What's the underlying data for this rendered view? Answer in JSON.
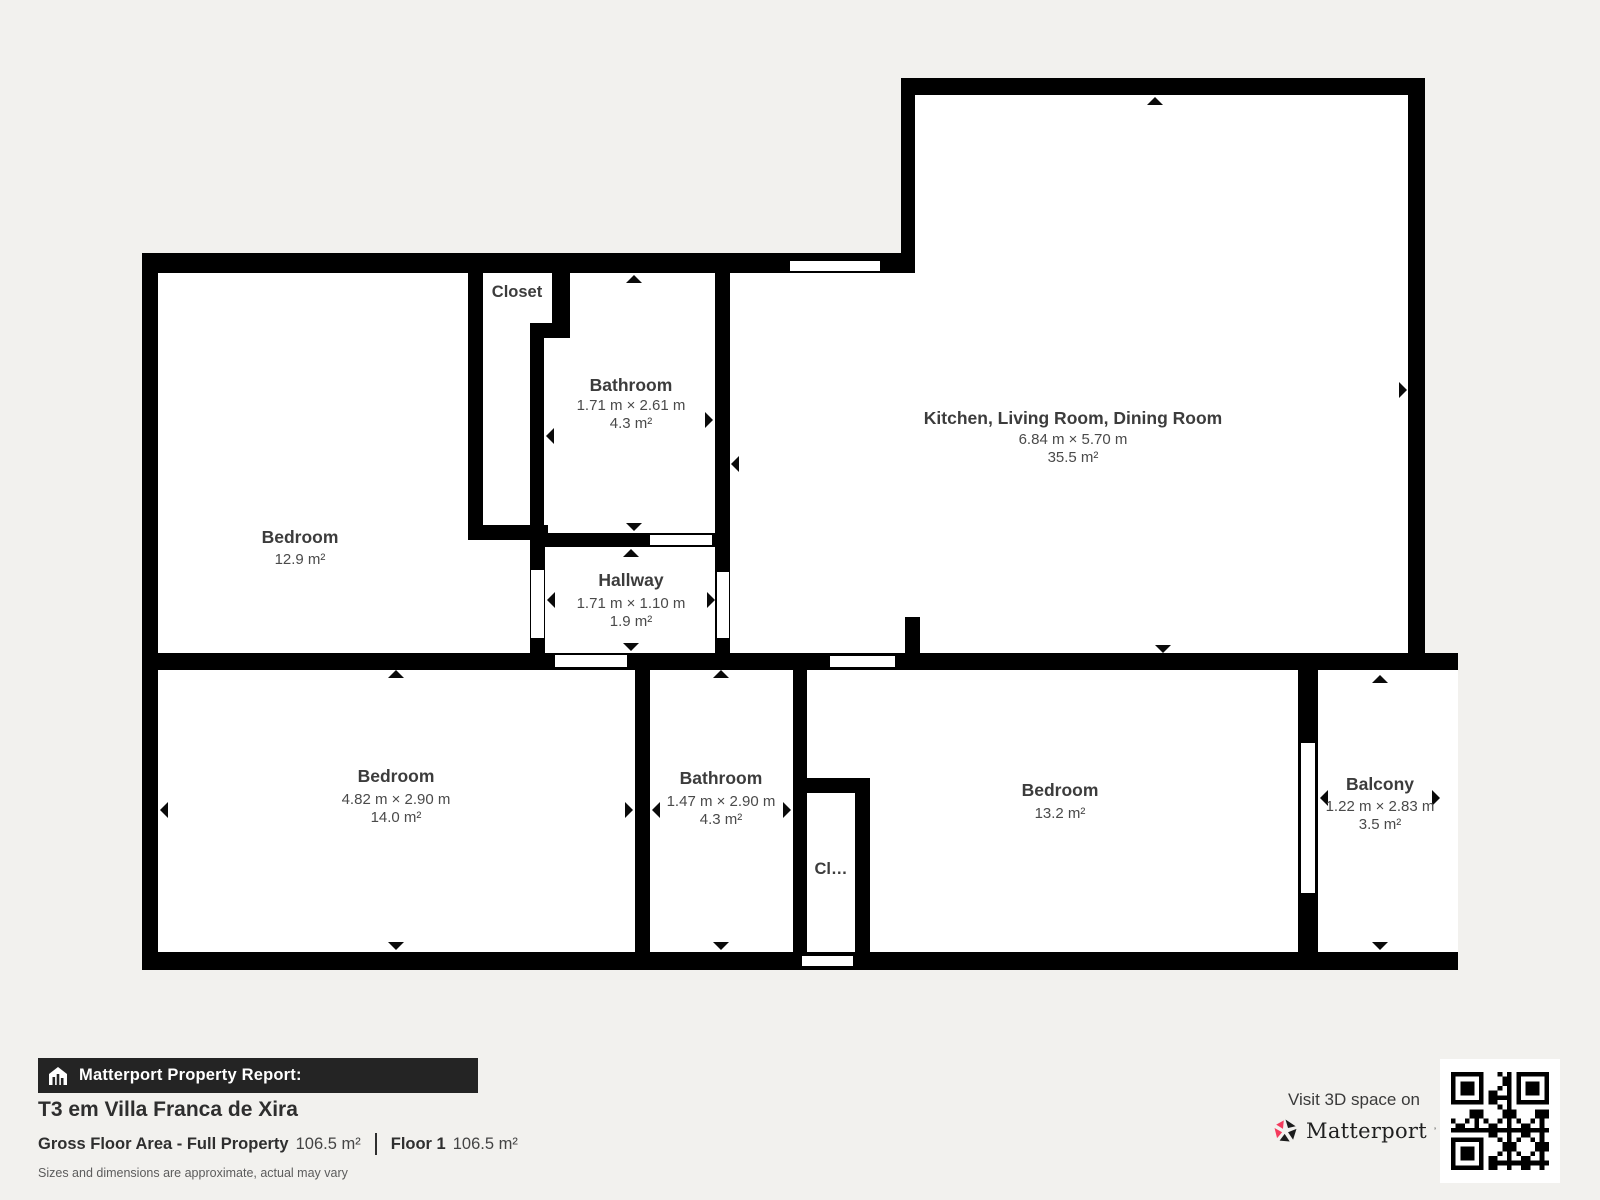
{
  "plan": {
    "wall_color": "#000000",
    "room_fill": "#ffffff",
    "label_color": "#3c3c3c",
    "rooms": [
      {
        "id": "bedroom-top-left",
        "name": "Bedroom",
        "area": "12.9 m²"
      },
      {
        "id": "closet-top",
        "name": "Closet"
      },
      {
        "id": "bathroom-top",
        "name": "Bathroom",
        "dims": "1.71 m × 2.61 m",
        "area": "4.3 m²"
      },
      {
        "id": "kitchen-living-dining",
        "name": "Kitchen, Living Room, Dining Room",
        "dims": "6.84 m × 5.70 m",
        "area": "35.5 m²"
      },
      {
        "id": "hallway",
        "name": "Hallway",
        "dims": "1.71 m × 1.10 m",
        "area": "1.9 m²"
      },
      {
        "id": "bedroom-bottom-left",
        "name": "Bedroom",
        "dims": "4.82 m × 2.90 m",
        "area": "14.0 m²"
      },
      {
        "id": "bathroom-bottom",
        "name": "Bathroom",
        "dims": "1.47 m × 2.90 m",
        "area": "4.3 m²"
      },
      {
        "id": "closet-bottom",
        "name": "Cl…"
      },
      {
        "id": "bedroom-bottom-right",
        "name": "Bedroom",
        "area": "13.2 m²"
      },
      {
        "id": "balcony",
        "name": "Balcony",
        "dims": "1.22 m × 2.83 m",
        "area": "3.5 m²"
      }
    ]
  },
  "footer": {
    "report_label": "Matterport Property Report:",
    "title": "T3 em Villa Franca de Xira",
    "gross_label": "Gross Floor Area - Full Property",
    "gross_value": "106.5 m²",
    "floor_label": "Floor 1",
    "floor_value": "106.5 m²",
    "disclaimer": "Sizes and dimensions are approximate, actual may vary",
    "visit_label": "Visit 3D space on",
    "brand": "Matterport",
    "brand_mark": "’",
    "bar_color": "#242424",
    "brand_pink": "#f43a5c"
  }
}
